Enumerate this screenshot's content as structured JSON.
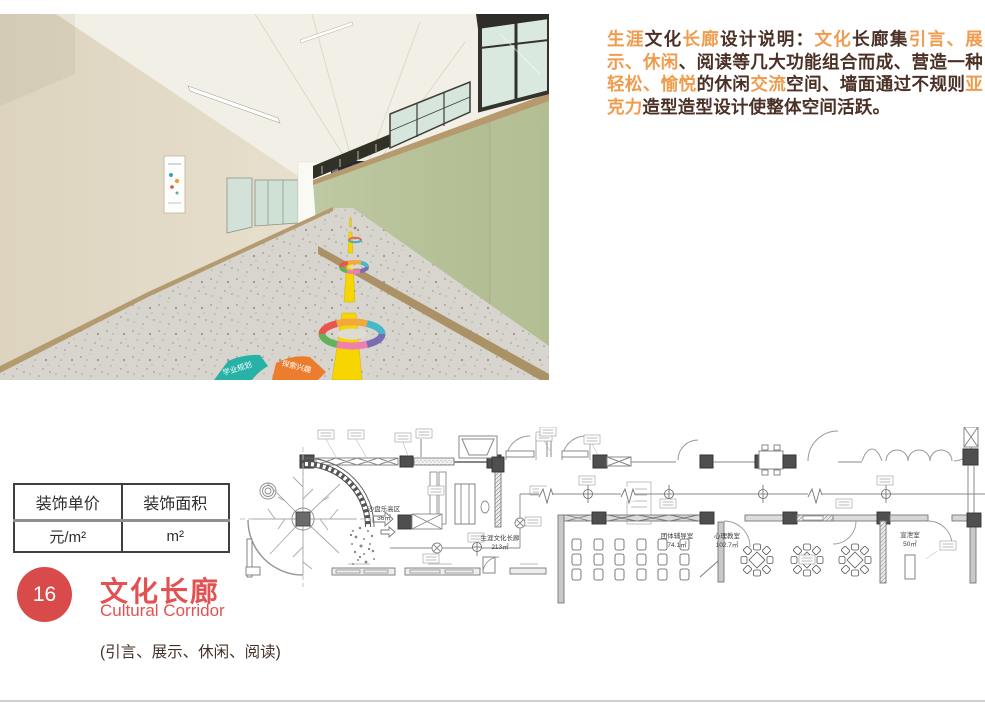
{
  "page": {
    "background": "#ffffff"
  },
  "photo": {
    "floor_signs": [
      "学业规划",
      "探索兴趣"
    ],
    "colors": {
      "left_wall": "#ded6c2",
      "right_wall": "#b4bf95",
      "trim": "#b69a6e",
      "floor": "#d8d5ce",
      "center_line": "#f6d500"
    }
  },
  "description": {
    "colors": {
      "text": "#4b3026",
      "highlight": "#f09c4e"
    },
    "segments": [
      {
        "text": "生涯",
        "highlight": true
      },
      {
        "text": "文化",
        "highlight": false
      },
      {
        "text": "长廊",
        "highlight": true
      },
      {
        "text": "设计说明：",
        "highlight": false
      },
      {
        "text": "文化",
        "highlight": true
      },
      {
        "text": "长廊集",
        "highlight": false
      },
      {
        "text": "引言、展示、休闲",
        "highlight": true
      },
      {
        "text": "、阅读等几大功能组合而成、营造一种",
        "highlight": false
      },
      {
        "text": "轻松、愉悦",
        "highlight": true
      },
      {
        "text": "的休闲",
        "highlight": false
      },
      {
        "text": "交流",
        "highlight": true
      },
      {
        "text": "空间、墙面通过不规则",
        "highlight": false
      },
      {
        "text": "亚克力",
        "highlight": true
      },
      {
        "text": "造型造型设计使整体空间活跃。",
        "highlight": false
      }
    ]
  },
  "table": {
    "headers": [
      "装饰单价",
      "装饰面积"
    ],
    "values": [
      "元/m²",
      "m²"
    ]
  },
  "badge": {
    "number": "16",
    "color": "#d94b4b"
  },
  "title": {
    "zh": "文化长廊",
    "en": "Cultural Corridor",
    "color": "#e25252"
  },
  "subtitle": "(引言、展示、休闲、阅读)",
  "floorplan": {
    "rooms": [
      {
        "name": "沙盘乐高区",
        "area": "36㎡"
      },
      {
        "name": "生涯文化长廊",
        "area": "213㎡"
      },
      {
        "name": "团体辅导室",
        "area": "74.1㎡"
      },
      {
        "name": "心理教室",
        "area": "102.7㎡"
      },
      {
        "name": "宣泄室",
        "area": "50㎡"
      }
    ]
  }
}
